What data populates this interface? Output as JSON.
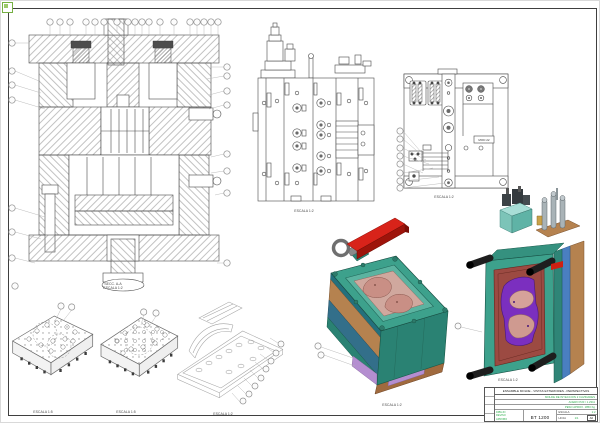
{
  "page": {
    "background": "#ffffff",
    "frame_color": "#3f3f3f"
  },
  "corner_icon": {
    "name": "viewer-corner-marker",
    "color": "#76b043"
  },
  "captions": {
    "section_line1": "SECC. A-A",
    "section_line2": "ESCALA 1:2",
    "side_view": "ESCALA 1:2",
    "plan_view": "ESCALA 1:2",
    "plate_a": "ESCALA 1:5",
    "plate_b": "ESCALA 1:5",
    "wireframe": "ESCALA 1:2",
    "iso_front": "ESCALA 1:2",
    "iso_rear": "ESCALA 1:2"
  },
  "plan_view": {
    "nameplate_text": "MOD 22"
  },
  "title_block": {
    "title": "ENSAMBLE MOLDE - VISTAS EXTERIORES - PERSPECTIVAS",
    "field_rows": [
      "MOLDE DE INYECCION 2 CAVIDADES",
      "ACERO P20 / 1.2311",
      "PESO APROX. 1850 Kg"
    ],
    "sign_labels": [
      "DIBUJO",
      "REVISO",
      "APROBO"
    ],
    "drawing_number": "BT 1200",
    "scale_label": "ESCALA",
    "scale_value": "1:2",
    "sheet_label": "HOJA",
    "sheet_value": "1/1",
    "size_value": "A0"
  },
  "colors": {
    "mold_teal": "#3da18c",
    "mold_teal_dark": "#2a8273",
    "strap_red": "#d8231a",
    "plate_copper": "#b5824f",
    "plate_blue": "#4a7fc0",
    "cavity_pink": "#d0a89e",
    "insert_maroon": "#9c4a42",
    "insert_purple": "#7b2fbf",
    "accent_lavender": "#b48ed0",
    "title_green": "#2fae4e",
    "line": "#4a4a4a"
  }
}
